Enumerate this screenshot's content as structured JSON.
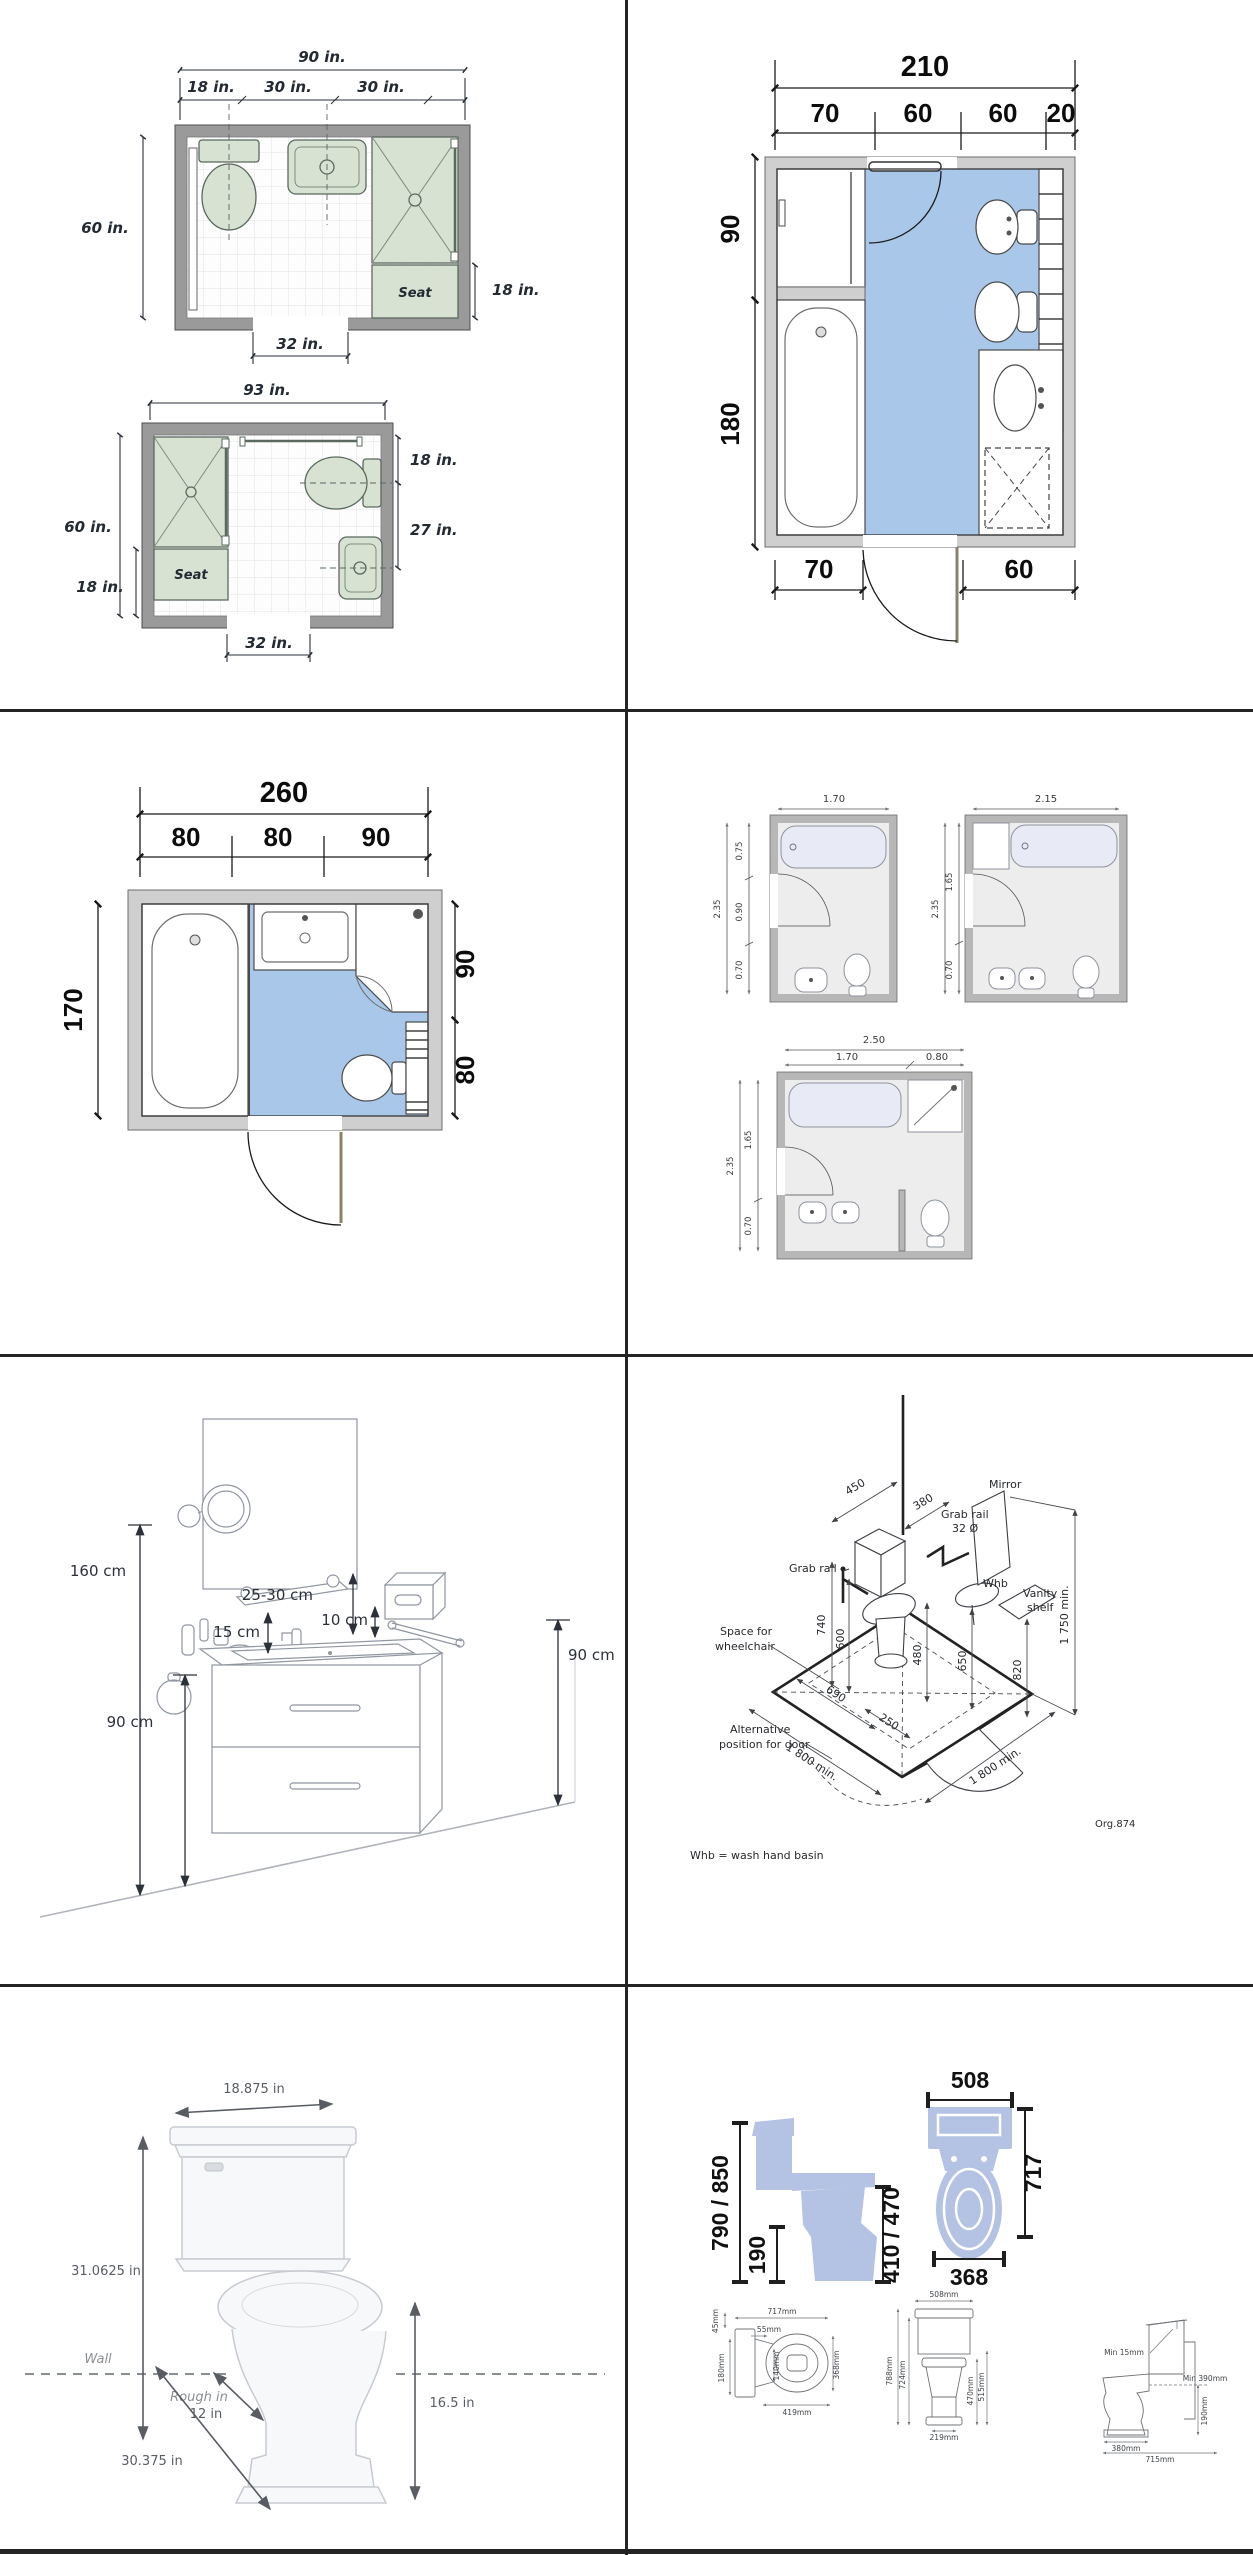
{
  "colors": {
    "floor_blue": "#a9c7e8",
    "fixture_green": "#d7e2d3",
    "silhouette_blue": "#b4c3e4",
    "wall_gray": "#9a9a9a",
    "wall_light": "#cfcfcf"
  },
  "plan90": {
    "total": "90 in.",
    "seg1": "18 in.",
    "seg2": "30 in.",
    "seg3": "30 in.",
    "left": "60 in.",
    "right": "18 in.",
    "bottom": "32 in.",
    "seat": "Seat"
  },
  "plan93": {
    "total": "93 in.",
    "left": "60 in.",
    "left_seat": "18 in.",
    "right_top": "18 in.",
    "right_mid": "27 in.",
    "bottom": "32 in.",
    "seat": "Seat"
  },
  "plan210": {
    "total": "210",
    "seg1": "70",
    "seg2": "60",
    "seg3": "60",
    "seg4": "20",
    "left_top": "90",
    "left_bottom": "180",
    "bottom_left": "70",
    "bottom_right": "60"
  },
  "plan260": {
    "total": "260",
    "seg1": "80",
    "seg2": "80",
    "seg3": "90",
    "left": "170",
    "right_top": "90",
    "right_bottom": "80"
  },
  "plansMetric": {
    "a_top": "1.70",
    "a_total": "2.35",
    "a_s1": "0.75",
    "a_s2": "0.90",
    "a_s3": "0.70",
    "b_top": "2.15",
    "b_total": "2.35",
    "b_s1": "1.65",
    "b_s2": "0.70",
    "c_total_w": "2.50",
    "c_s1": "1.70",
    "c_s2": "0.80",
    "c_total_h": "2.35",
    "c_s3": "1.65",
    "c_s4": "0.70"
  },
  "vanity": {
    "mirror_h": "160 cm",
    "shelf": "25-30 cm",
    "acc": "15 cm",
    "disp": "10 cm",
    "rail": "90 cm",
    "ring": "90 cm"
  },
  "iso": {
    "d450": "450",
    "d380": "380",
    "grab_right": "Grab rail",
    "dia": "32 Ø",
    "mirror": "Mirror",
    "grab_left": "Grab rail",
    "whb": "Whb",
    "vshelf1": "Vanity",
    "vshelf2": "shelf",
    "d740": "740",
    "d600": "600",
    "d480": "480",
    "d690": "690",
    "d250": "250",
    "d650": "650",
    "d820": "820",
    "d1750": "1 750 min.",
    "space1": "Space for",
    "space2": "wheelchair",
    "alt1": "Alternative",
    "alt2": "position for door",
    "d1800l": "1 800 min.",
    "d1800r": "1 800 min.",
    "ref": "Org.874",
    "note": "Whb = wash hand basin"
  },
  "toiletSide": {
    "width": "18.875 in",
    "height": "31.0625 in",
    "wall": "Wall",
    "rough": "Rough in",
    "rough_val": "12 in",
    "depth": "30.375 in",
    "seat_h": "16.5 in"
  },
  "toiletBlue": {
    "side_h": "790 / 850",
    "outlet": "190",
    "seat_h": "410 / 470",
    "top_w": "508",
    "top_d": "717",
    "bowl_w": "368"
  },
  "specTop": {
    "w": "717mm",
    "a": "55mm",
    "b": "45mm",
    "c": "180mm",
    "d": "140mm",
    "e": "368mm",
    "f": "419mm"
  },
  "specFront": {
    "w": "508mm",
    "l1": "788mm",
    "l2": "724mm",
    "r1": "470mm",
    "r2": "515mm",
    "base": "219mm"
  },
  "specSide": {
    "gap": "Min 15mm",
    "pipe": "Min 390mm",
    "h": "190mm",
    "base": "380mm",
    "depth": "715mm"
  }
}
